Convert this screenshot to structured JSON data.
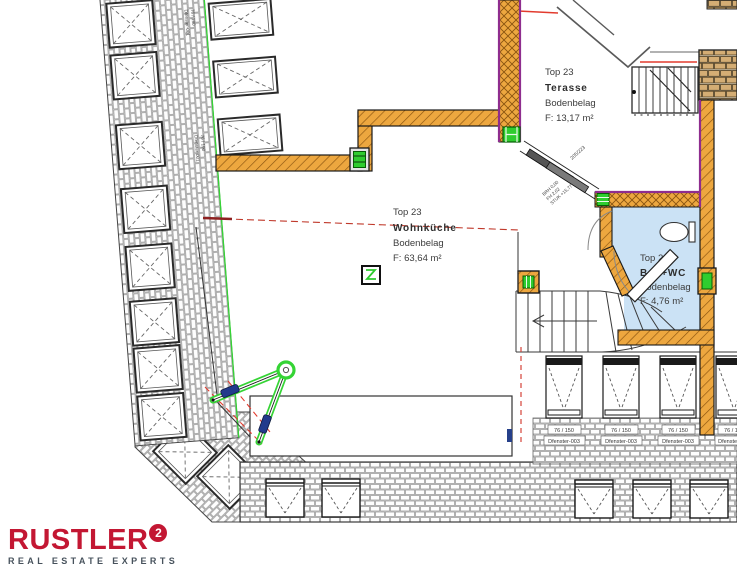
{
  "rooms": {
    "wohnkueche": {
      "unit": "Top 23",
      "name": "Wohnküche",
      "flooring": "Bodenbelag",
      "area": "F: 63,64 m²"
    },
    "terasse": {
      "unit": "Top 23",
      "name": "Terasse",
      "flooring": "Bodenbelag",
      "area": "F: 13,17 m²"
    },
    "bad": {
      "unit": "Top 23",
      "name": "Bad+WC",
      "flooring": "Bodenbelag",
      "area": "F: 4,76 m²"
    }
  },
  "annotations": {
    "door_dim": "205/223",
    "door_note_1": "BRH 0,00",
    "door_note_2": "FH 2,02",
    "door_note_3": "STUK +15,77",
    "window_size_bottom": "76 / 150",
    "window_code_bottom": "Dfenster-003",
    "window_size_left": "76 / 190",
    "window_code_left": "Dfenster-001"
  },
  "logo": {
    "brand": "RUSTLER",
    "superscript": "2",
    "tagline": "REAL ESTATE EXPERTS"
  },
  "colors": {
    "wall_wood": "#EDA73F",
    "wall_purple": "#8E2D8E",
    "bath_fill": "#CBE2F5",
    "brick_tan": "#D4AD74",
    "accent_green": "#2FCC2F",
    "line_red": "#E23B2E",
    "logo_red": "#C31733",
    "tagline_gray": "#47525C"
  }
}
